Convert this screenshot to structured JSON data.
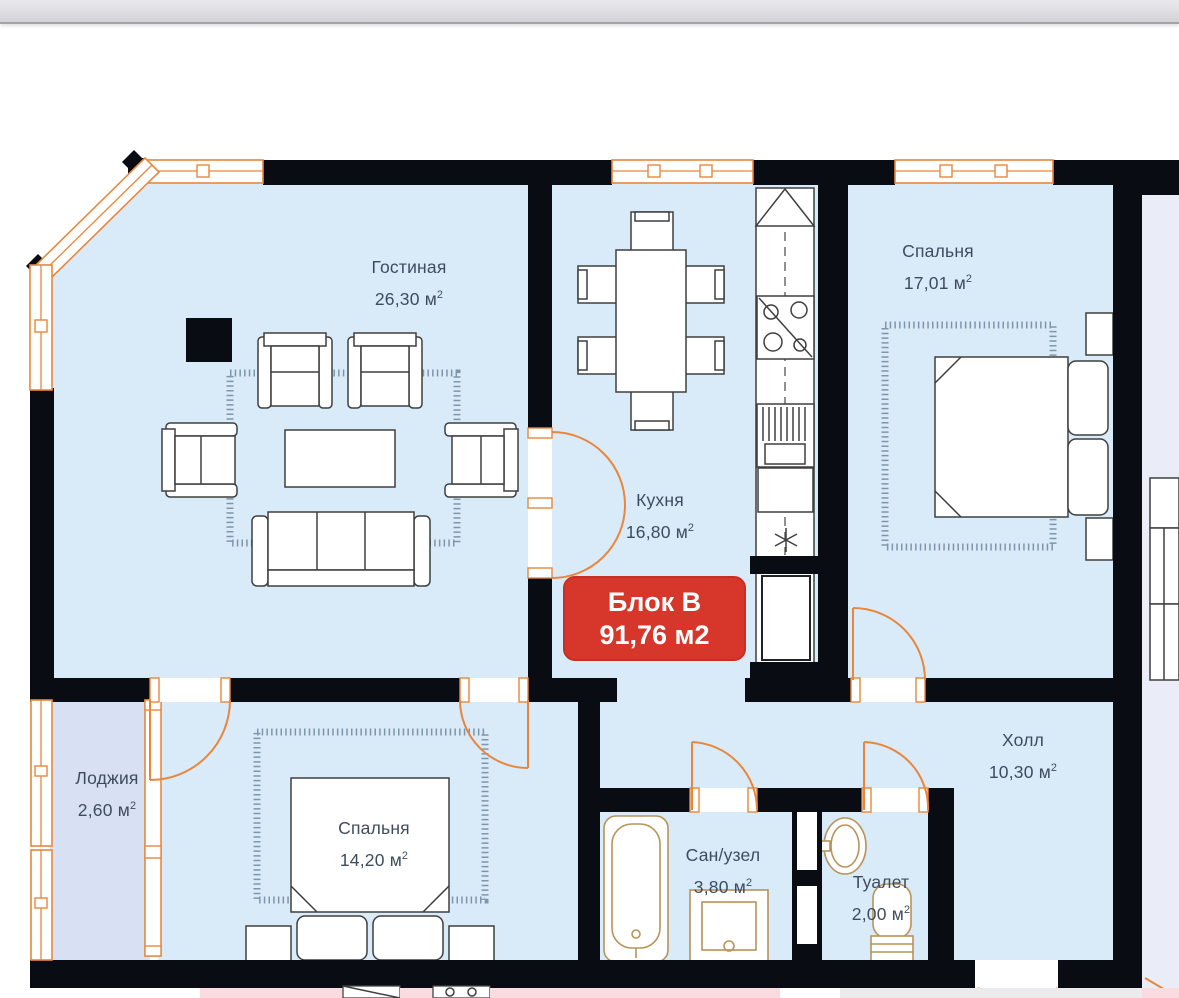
{
  "badge": {
    "line1": "Блок В",
    "line2": "91,76 м2"
  },
  "units": {
    "area_unit": "м",
    "area_sup": "2"
  },
  "rooms": {
    "living": {
      "name": "Гостиная",
      "area": "26,30"
    },
    "kitchen": {
      "name": "Кухня",
      "area": "16,80"
    },
    "bedroom1": {
      "name": "Спальня",
      "area": "17,01"
    },
    "bedroom2": {
      "name": "Спальня",
      "area": "14,20"
    },
    "loggia": {
      "name": "Лоджия",
      "area": "2,60"
    },
    "hall": {
      "name": "Холл",
      "area": "10,30"
    },
    "bathroom": {
      "name": "Сан/узел",
      "area": "3,80"
    },
    "toilet": {
      "name": "Туалет",
      "area": "2,00"
    }
  },
  "colors": {
    "wall": "#0a0c14",
    "room_fill": "#d9eaf8",
    "loggia_fill": "#d8e1f3",
    "neighbor_fill": "#eaecf8",
    "stair_fill": "#ebebee",
    "pink_fill": "#fadbdf",
    "orange": "#e8873c",
    "furniture_stroke": "#3f3f3f",
    "fixture_stroke": "#b8935a",
    "carpet_stroke": "#7e96ab",
    "badge_bg": "#d7372b",
    "badge_border": "#c62f24",
    "badge_text": "#ffffff",
    "label_text": "#3e4c5d",
    "topbar_top": "#e9e9ed",
    "topbar_bottom": "#d2d2d8",
    "topbar_line": "#a2a2a8"
  }
}
